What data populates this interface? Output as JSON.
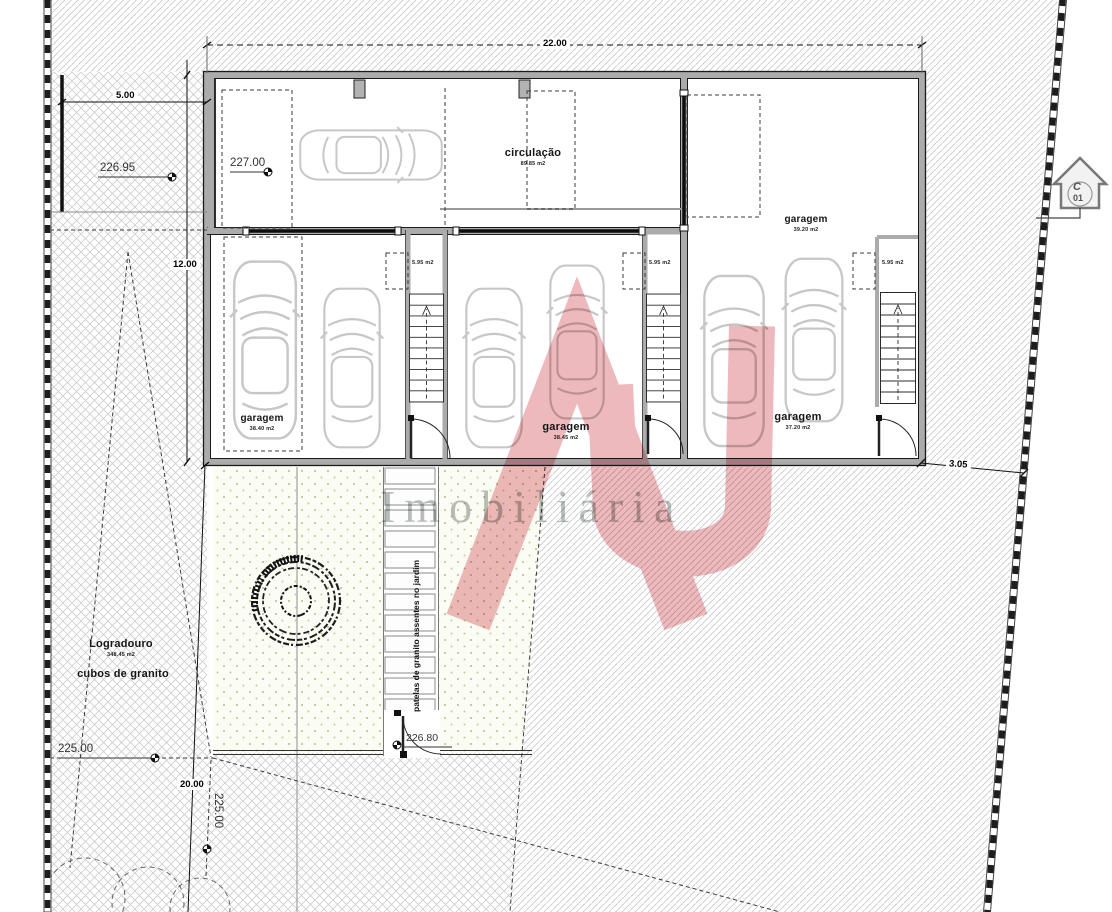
{
  "plan": {
    "dimensions": {
      "width_top": "22.00",
      "left_setback": "5.00",
      "depth_left": "12.00",
      "depth_bottom": "20.00",
      "right_gap": "3.05"
    },
    "elevations": {
      "upper_terrace": "226.95",
      "garage_floor": "227.00",
      "street_level": "225.00",
      "garden_entry": "226.80",
      "garden_level": "225.00"
    },
    "rooms": {
      "circulacao": {
        "name": "circulação",
        "area": "89.85 m2"
      },
      "garagem_right": {
        "name": "garagem",
        "area": "39.20 m2"
      },
      "garagem_1": {
        "name": "garagem",
        "area": "38.40 m2"
      },
      "garagem_2": {
        "name": "garagem",
        "area": "38.45 m2"
      },
      "garagem_3": {
        "name": "garagem",
        "area": "37.20 m2"
      },
      "stair_1_area": "5.95 m2",
      "stair_2_area": "5.95 m2",
      "stair_3_area": "5.95 m2"
    },
    "site": {
      "logradouro": {
        "name": "Logradouro",
        "area": "348.45 m2"
      },
      "paving_label": "cubos de granito",
      "walkway_label": "patelas de granito assentes no jardim"
    },
    "section_marker": {
      "letter": "C",
      "number": "01"
    }
  },
  "watermark": {
    "text": "Imobiliária",
    "logo_monogram": "AS",
    "logo_color": "#cc2936"
  }
}
